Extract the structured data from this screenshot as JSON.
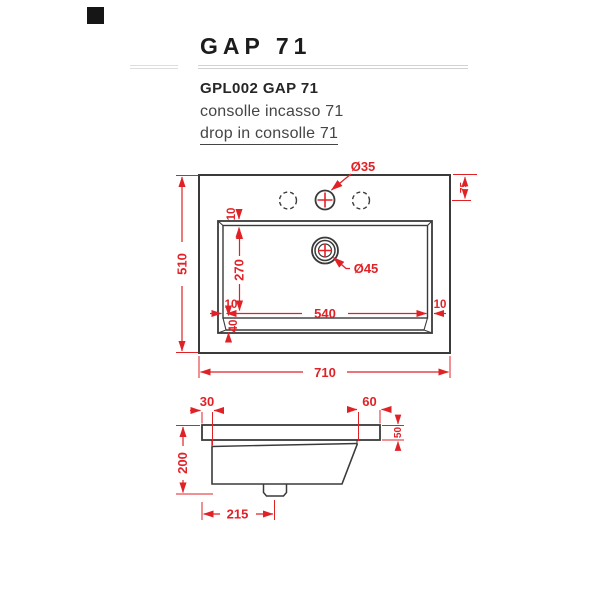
{
  "header": {
    "title": "GAP 71",
    "product_code": "GPL002 GAP 71",
    "subtitle_it": "consolle incasso 71",
    "subtitle_en": "drop in consolle 71"
  },
  "colors": {
    "dimension_red": "#e02227",
    "drawing_line": "#3a3a3a",
    "rule_gray": "#d2d2d2"
  },
  "top_view": {
    "overall_width": "710",
    "overall_depth": "510",
    "basin_width": "540",
    "basin_depth": "270",
    "rim_top": "10",
    "rim_left": "10",
    "rim_right": "10",
    "basin_slope": "40",
    "tap_offset": "75",
    "tap_hole_diameter": "Ø35",
    "drain_diameter": "Ø45"
  },
  "side_view": {
    "back_edge": "30",
    "front_edge": "60",
    "front_height": "50",
    "overall_height": "200",
    "drain_offset": "215"
  }
}
